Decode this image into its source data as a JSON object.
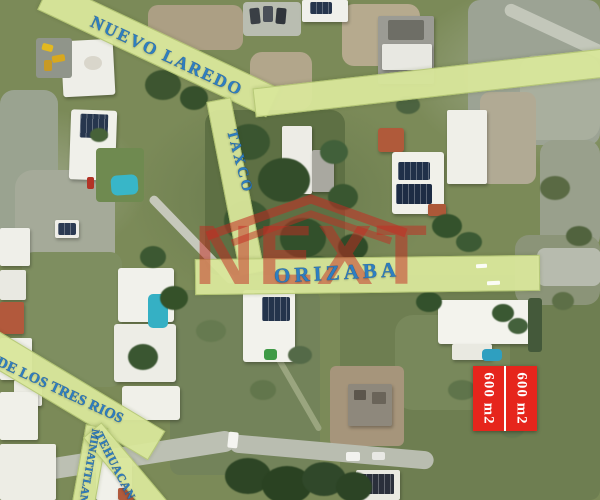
{
  "map": {
    "streets": [
      {
        "id": "nuevo-laredo",
        "name": "NUEVO LAREDO"
      },
      {
        "id": "taxco",
        "name": "TAXCO"
      },
      {
        "id": "orizaba",
        "name": "ORIZABA"
      },
      {
        "id": "de-los-tres-rios",
        "name": "DE LOS TRES RIOS"
      },
      {
        "id": "minatitlan",
        "name": "MINATITLAN"
      },
      {
        "id": "tehuacan",
        "name": "TEHUACAN"
      }
    ],
    "colors": {
      "street_band": "#d9e79b",
      "street_text": "#2e7fc2",
      "watermark_red": "#c42b22",
      "lot_red": "#e6251c",
      "lot_text": "#ffffff"
    },
    "watermark": {
      "text": "NEXT"
    },
    "lot_overlay": {
      "labels": [
        "600 m2",
        "600 m2"
      ]
    }
  }
}
